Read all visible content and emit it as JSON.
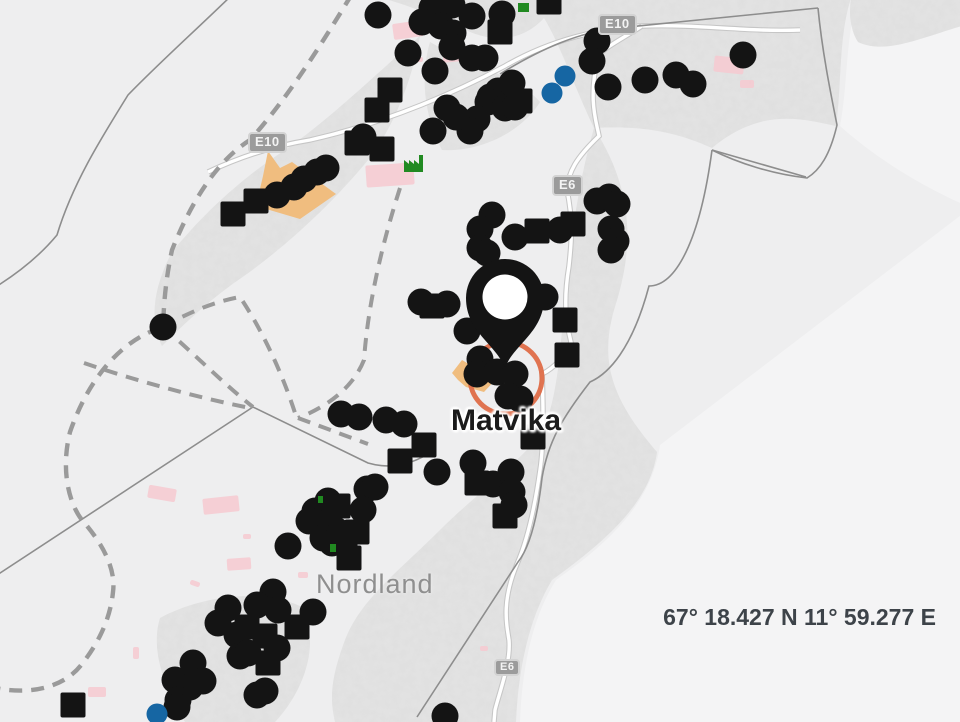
{
  "map": {
    "place_label": "Matvika",
    "region_label": "Nordland",
    "coordinate_readout": "67° 18.427 N 11° 59.277 E",
    "road_shields": [
      {
        "label": "E10",
        "x": 598,
        "y": 14,
        "small": false
      },
      {
        "label": "E10",
        "x": 248,
        "y": 132,
        "small": false
      },
      {
        "label": "E6",
        "x": 552,
        "y": 175,
        "small": false
      },
      {
        "label": "E6",
        "x": 494,
        "y": 659,
        "small": true
      }
    ],
    "colors": {
      "marker_black": "#141414",
      "marker_blue": "#1666a3",
      "selection_ring": "#de6b47",
      "zone_orange": "#f0bd7f",
      "zone_pink": "#f6c9d0",
      "green_icon": "#218a21",
      "pin_fill": "#141414",
      "pin_hole": "#ffffff"
    },
    "pin": {
      "x": 505,
      "y": 368
    },
    "selection_ring": {
      "x": 506,
      "y": 378,
      "r": 36
    },
    "markers": {
      "site_circles": [
        [
          378,
          15
        ],
        [
          432,
          8
        ],
        [
          452,
          5
        ],
        [
          472,
          16
        ],
        [
          502,
          14
        ],
        [
          422,
          22
        ],
        [
          441,
          26
        ],
        [
          453,
          33
        ],
        [
          408,
          53
        ],
        [
          452,
          47
        ],
        [
          472,
          58
        ],
        [
          485,
          58
        ],
        [
          435,
          71
        ],
        [
          490,
          97
        ],
        [
          498,
          91
        ],
        [
          512,
          83
        ],
        [
          488,
          102
        ],
        [
          505,
          108
        ],
        [
          515,
          107
        ],
        [
          477,
          119
        ],
        [
          470,
          131
        ],
        [
          447,
          108
        ],
        [
          456,
          117
        ],
        [
          433,
          131
        ],
        [
          363,
          137
        ],
        [
          597,
          41
        ],
        [
          592,
          61
        ],
        [
          608,
          87
        ],
        [
          645,
          80
        ],
        [
          676,
          75
        ],
        [
          693,
          84
        ],
        [
          743,
          55
        ],
        [
          277,
          195
        ],
        [
          294,
          187
        ],
        [
          304,
          179
        ],
        [
          317,
          172
        ],
        [
          326,
          168
        ],
        [
          163,
          327
        ],
        [
          597,
          201
        ],
        [
          609,
          197
        ],
        [
          617,
          204
        ],
        [
          611,
          229
        ],
        [
          616,
          241
        ],
        [
          611,
          250
        ],
        [
          492,
          215
        ],
        [
          480,
          229
        ],
        [
          480,
          248
        ],
        [
          515,
          237
        ],
        [
          560,
          230
        ],
        [
          487,
          253
        ],
        [
          545,
          297
        ],
        [
          467,
          331
        ],
        [
          447,
          304
        ],
        [
          421,
          302
        ],
        [
          480,
          359
        ],
        [
          477,
          374
        ],
        [
          497,
          372
        ],
        [
          515,
          374
        ],
        [
          520,
          399
        ],
        [
          508,
          396
        ],
        [
          341,
          414
        ],
        [
          359,
          417
        ],
        [
          386,
          420
        ],
        [
          404,
          424
        ],
        [
          437,
          472
        ],
        [
          473,
          463
        ],
        [
          493,
          484
        ],
        [
          511,
          472
        ],
        [
          512,
          492
        ],
        [
          514,
          505
        ],
        [
          367,
          489
        ],
        [
          375,
          487
        ],
        [
          328,
          501
        ],
        [
          315,
          511
        ],
        [
          309,
          521
        ],
        [
          332,
          510
        ],
        [
          327,
          523
        ],
        [
          337,
          531
        ],
        [
          323,
          538
        ],
        [
          332,
          543
        ],
        [
          363,
          510
        ],
        [
          288,
          546
        ],
        [
          273,
          592
        ],
        [
          257,
          605
        ],
        [
          278,
          610
        ],
        [
          228,
          608
        ],
        [
          218,
          623
        ],
        [
          237,
          635
        ],
        [
          240,
          656
        ],
        [
          248,
          653
        ],
        [
          277,
          648
        ],
        [
          313,
          612
        ],
        [
          257,
          695
        ],
        [
          265,
          691
        ],
        [
          193,
          663
        ],
        [
          175,
          680
        ],
        [
          190,
          687
        ],
        [
          203,
          681
        ],
        [
          178,
          700
        ],
        [
          177,
          707
        ],
        [
          445,
          716
        ]
      ],
      "site_squares": [
        [
          549,
          2
        ],
        [
          500,
          32
        ],
        [
          390,
          90
        ],
        [
          377,
          110
        ],
        [
          357,
          143
        ],
        [
          382,
          149
        ],
        [
          520,
          101
        ],
        [
          233,
          214
        ],
        [
          256,
          201
        ],
        [
          537,
          231
        ],
        [
          573,
          224
        ],
        [
          565,
          320
        ],
        [
          567,
          355
        ],
        [
          432,
          306
        ],
        [
          533,
          437
        ],
        [
          424,
          445
        ],
        [
          400,
          461
        ],
        [
          477,
          483
        ],
        [
          505,
          516
        ],
        [
          338,
          506
        ],
        [
          357,
          532
        ],
        [
          345,
          542
        ],
        [
          349,
          558
        ],
        [
          247,
          627
        ],
        [
          265,
          636
        ],
        [
          268,
          663
        ],
        [
          297,
          627
        ],
        [
          73,
          705
        ]
      ],
      "blue_circles": [
        [
          565,
          76
        ],
        [
          552,
          93
        ],
        [
          157,
          714
        ]
      ],
      "green_bits": [
        {
          "x": 518,
          "y": 3,
          "w": 11,
          "h": 9
        },
        {
          "x": 330,
          "y": 544,
          "w": 6,
          "h": 8
        },
        {
          "x": 318,
          "y": 496,
          "w": 5,
          "h": 7
        }
      ],
      "factory_icon": {
        "x": 404,
        "y": 152
      },
      "pink_zones": [
        {
          "x": 393,
          "y": 22,
          "w": 30,
          "h": 16,
          "rot": -8
        },
        {
          "x": 443,
          "y": 56,
          "w": 18,
          "h": 6,
          "rot": -5
        },
        {
          "x": 410,
          "y": 57,
          "w": 13,
          "h": 5,
          "rot": 0
        },
        {
          "x": 366,
          "y": 164,
          "w": 48,
          "h": 22,
          "rot": -4
        },
        {
          "x": 714,
          "y": 57,
          "w": 30,
          "h": 16,
          "rot": 6
        },
        {
          "x": 740,
          "y": 80,
          "w": 14,
          "h": 8,
          "rot": 0
        },
        {
          "x": 148,
          "y": 487,
          "w": 28,
          "h": 13,
          "rot": 10
        },
        {
          "x": 203,
          "y": 497,
          "w": 36,
          "h": 16,
          "rot": -6
        },
        {
          "x": 227,
          "y": 558,
          "w": 24,
          "h": 12,
          "rot": -4
        },
        {
          "x": 88,
          "y": 687,
          "w": 18,
          "h": 10,
          "rot": 0
        },
        {
          "x": 190,
          "y": 581,
          "w": 10,
          "h": 5,
          "rot": 20
        },
        {
          "x": 298,
          "y": 572,
          "w": 10,
          "h": 6,
          "rot": 0
        },
        {
          "x": 133,
          "y": 647,
          "w": 6,
          "h": 12,
          "rot": 0
        },
        {
          "x": 243,
          "y": 534,
          "w": 8,
          "h": 5,
          "rot": 0
        },
        {
          "x": 480,
          "y": 646,
          "w": 8,
          "h": 5,
          "rot": 0
        }
      ]
    }
  }
}
